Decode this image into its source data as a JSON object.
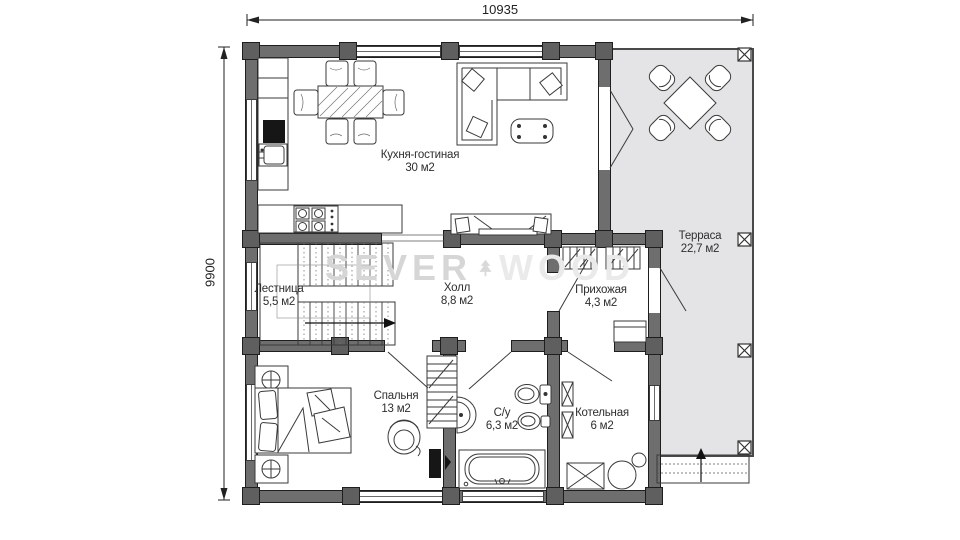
{
  "colors": {
    "bg": "#ffffff",
    "wall-fill": "#6e6e6e",
    "wall-edge": "#1e1e1e",
    "post-fill": "#5f5f5f",
    "terrace-fill": "#e4e4e6",
    "line": "#3a3a3a",
    "label": "#2e2e2e",
    "wm-dark": "#d6d6d6",
    "wm-light": "#eaeaea"
  },
  "dimensions": {
    "top": "10935",
    "left": "9900"
  },
  "watermark": {
    "left": "SEVER",
    "right": "WOOD"
  },
  "rooms": [
    {
      "name": "Кухня-гостиная",
      "area": "30 м2"
    },
    {
      "name": "Терраса",
      "area": "22,7 м2"
    },
    {
      "name": "Лестница",
      "area": "5,5 м2"
    },
    {
      "name": "Холл",
      "area": "8,8 м2"
    },
    {
      "name": "Прихожая",
      "area": "4,3 м2"
    },
    {
      "name": "Спальня",
      "area": "13 м2"
    },
    {
      "name": "С/у",
      "area": "6,3 м2"
    },
    {
      "name": "Котельная",
      "area": "6 м2"
    }
  ]
}
